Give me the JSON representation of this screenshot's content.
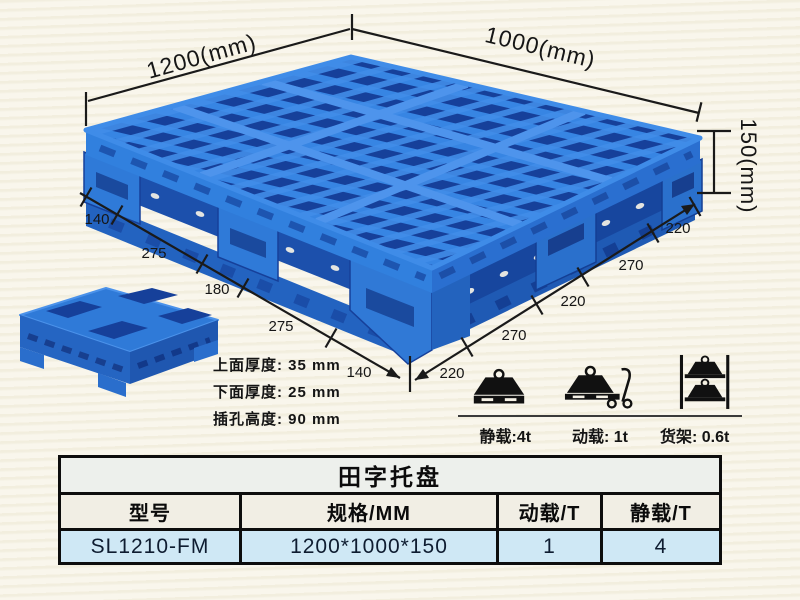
{
  "dimensions": {
    "width_label": "1200(mm)",
    "depth_label": "1000(mm)",
    "height_label": "150(mm)",
    "left_edge_segments": [
      "140",
      "275",
      "180",
      "275",
      "140"
    ],
    "right_edge_segments": [
      "220",
      "270",
      "220",
      "270",
      "220"
    ]
  },
  "thickness_specs": [
    "上面厚度: 35 mm",
    "下面厚度: 25 mm",
    "插孔高度: 90 mm"
  ],
  "load_ratings": [
    {
      "icon": "static-load-icon",
      "caption": "静载:4t"
    },
    {
      "icon": "dynamic-load-icon",
      "caption": "动载: 1t"
    },
    {
      "icon": "rack-load-icon",
      "caption": "货架: 0.6t"
    }
  ],
  "spec_table": {
    "title": "田字托盘",
    "columns": [
      "型号",
      "规格/MM",
      "动载/T",
      "静载/T"
    ],
    "row": {
      "model": "SL1210-FM",
      "spec": "1200*1000*150",
      "dynamic_load": "1",
      "static_load": "4"
    }
  },
  "colors": {
    "pallet_blue": "#2f7ad8",
    "pallet_dark_blue": "#16409a",
    "pallet_light_blue": "#4e94ec",
    "background_cream": "#f9f6ec",
    "table_row_blue": "#cfe8f5",
    "annotation_black": "#1a1a1a"
  }
}
